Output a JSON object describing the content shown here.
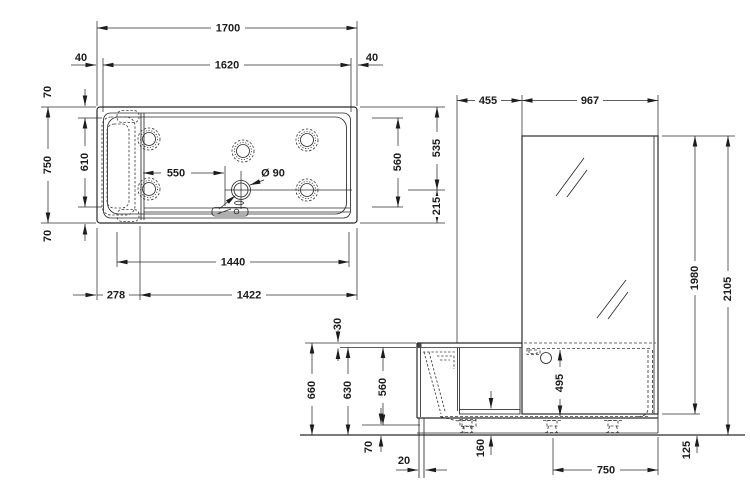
{
  "colors": {
    "line": "#2b2b2b",
    "text": "#1c1c1c",
    "background": "#ffffff"
  },
  "plan": {
    "overall_width": "1700",
    "inner_width": "1620",
    "rim_left": "40",
    "rim_right": "40",
    "overall_depth": "750",
    "inner_depth": "610",
    "rim_top": "70",
    "rim_bottom": "70",
    "seat_to_drain": "550",
    "drain_diameter": "Ø 90",
    "right_inner": "560",
    "right_upper": "535",
    "right_lower": "215",
    "bottom_span": "1440",
    "bottom_left": "278",
    "bottom_right": "1422"
  },
  "elevation": {
    "door_section_width": "455",
    "glass_width": "967",
    "glass_height": "1980",
    "total_height": "2105",
    "rim_height": "30",
    "tub_height": "660",
    "tub_inner_height": "630",
    "door_height": "560",
    "tub_depth": "495",
    "base_height": "70",
    "panel_inset": "20",
    "threshold_height": "160",
    "feet_spacing": "750",
    "glass_clearance": "125"
  }
}
